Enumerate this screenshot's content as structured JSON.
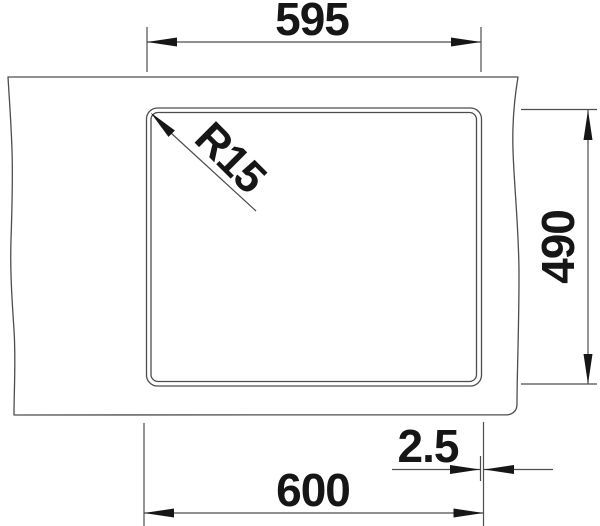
{
  "drawing": {
    "type": "technical-drawing",
    "subject": "sink-cutout-top-view",
    "colors": {
      "background": "#ffffff",
      "line": "#4d4d4d",
      "text": "#161616"
    },
    "dimensions": {
      "top_width": {
        "label": "595",
        "orientation": "horizontal"
      },
      "right_height": {
        "label": "490",
        "orientation": "vertical"
      },
      "bottom_width": {
        "label": "600",
        "orientation": "horizontal"
      },
      "rim_offset": {
        "label": "2.5",
        "orientation": "horizontal"
      },
      "corner_radius": {
        "label": "R15",
        "orientation": "diagonal-45"
      }
    }
  }
}
